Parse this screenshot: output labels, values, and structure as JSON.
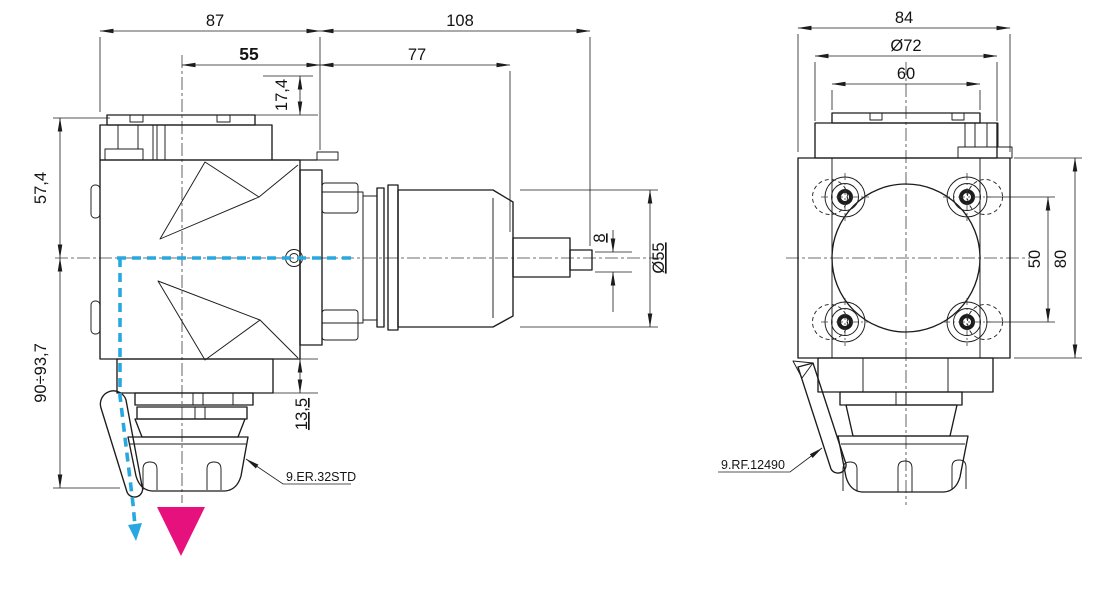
{
  "drawing": {
    "background": "#ffffff",
    "line_color": "#1c1c1c",
    "coolant_color": "#29a8e0",
    "feed_arrow_color": "#e7117d",
    "side_view": {
      "dims": {
        "body_width": "87",
        "shank_length": "108",
        "axis_to_flange": "55",
        "flange_to_shoulder": "77",
        "nose_offset": "17,4",
        "top_to_axis": "57,4",
        "axis_to_nose_range": "90÷93,7",
        "flange_thickness": "13,5",
        "tang_width": "8",
        "shank_diameter": "Ø55"
      },
      "collet_label": "9.ER.32STD"
    },
    "front_view": {
      "dims": {
        "body_width": "84",
        "flange_diameter": "Ø72",
        "spigot_diameter": "60",
        "bolt_spacing": "50",
        "body_height": "80"
      },
      "coolant_label": "9.RF.12490"
    }
  }
}
